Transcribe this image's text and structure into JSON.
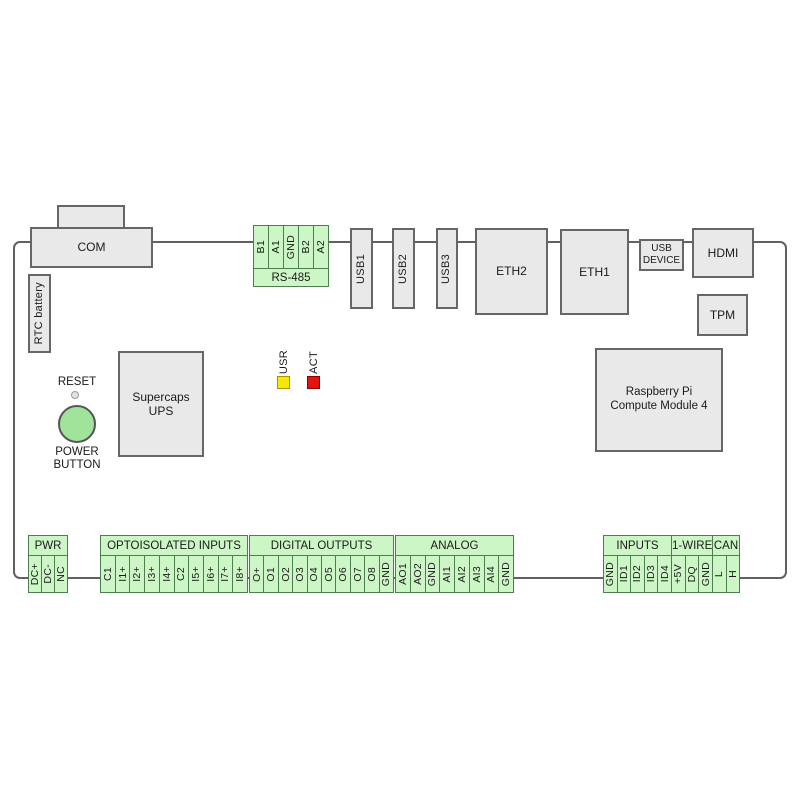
{
  "board": {
    "top": {
      "com": "COM",
      "rtc_battery": "RTC battery",
      "rs485": {
        "title": "RS-485",
        "pins": [
          "B1",
          "A1",
          "GND",
          "B2",
          "A2"
        ]
      },
      "usb1": "USB1",
      "usb2": "USB2",
      "usb3": "USB3",
      "eth2": "ETH2",
      "eth1": "ETH1",
      "usb_device": {
        "line1": "USB",
        "line2": "DEVICE"
      },
      "hdmi": "HDMI",
      "tpm": "TPM"
    },
    "middle": {
      "reset": "RESET",
      "power_button": {
        "line1": "POWER",
        "line2": "BUTTON"
      },
      "supercaps": {
        "line1": "Supercaps",
        "line2": "UPS"
      },
      "leds": {
        "usr": "USR",
        "act": "ACT"
      },
      "cm4": {
        "line1": "Raspberry Pi",
        "line2": "Compute Module 4"
      }
    },
    "bottom": {
      "pwr": {
        "title": "PWR",
        "pins": [
          "DC+",
          "DC-",
          "NC"
        ]
      },
      "optoisolated_inputs": {
        "title": "OPTOISOLATED INPUTS",
        "pins": [
          "C1",
          "I1+",
          "I2+",
          "I3+",
          "I4+",
          "C2",
          "I5+",
          "I6+",
          "I7+",
          "I8+"
        ]
      },
      "digital_outputs": {
        "title": "DIGITAL OUTPUTS",
        "pins": [
          "O+",
          "O1",
          "O2",
          "O3",
          "O4",
          "O5",
          "O6",
          "O7",
          "O8",
          "GND"
        ]
      },
      "analog": {
        "title": "ANALOG",
        "pins": [
          "AO1",
          "AO2",
          "GND",
          "AI1",
          "AI2",
          "AI3",
          "AI4",
          "GND"
        ]
      },
      "inputs": {
        "title": "INPUTS",
        "pins": [
          "GND",
          "ID1",
          "ID2",
          "ID3",
          "ID4"
        ]
      },
      "one_wire": {
        "title": "1-WIRE",
        "pins": [
          "+5V",
          "DQ",
          "GND"
        ]
      },
      "can": {
        "title": "CAN",
        "pins": [
          "L",
          "H"
        ]
      }
    },
    "colors": {
      "green_fill": "#cdf6c6",
      "green_border": "#4e7d4e",
      "gray_fill": "#e9e9e9",
      "gray_border": "#666666",
      "outline": "#606060",
      "led_usr": "#f6e800",
      "led_usr_border": "#b98c00",
      "led_act": "#e51212",
      "led_act_border": "#8b0000",
      "power_button": "#a0e39b"
    }
  }
}
